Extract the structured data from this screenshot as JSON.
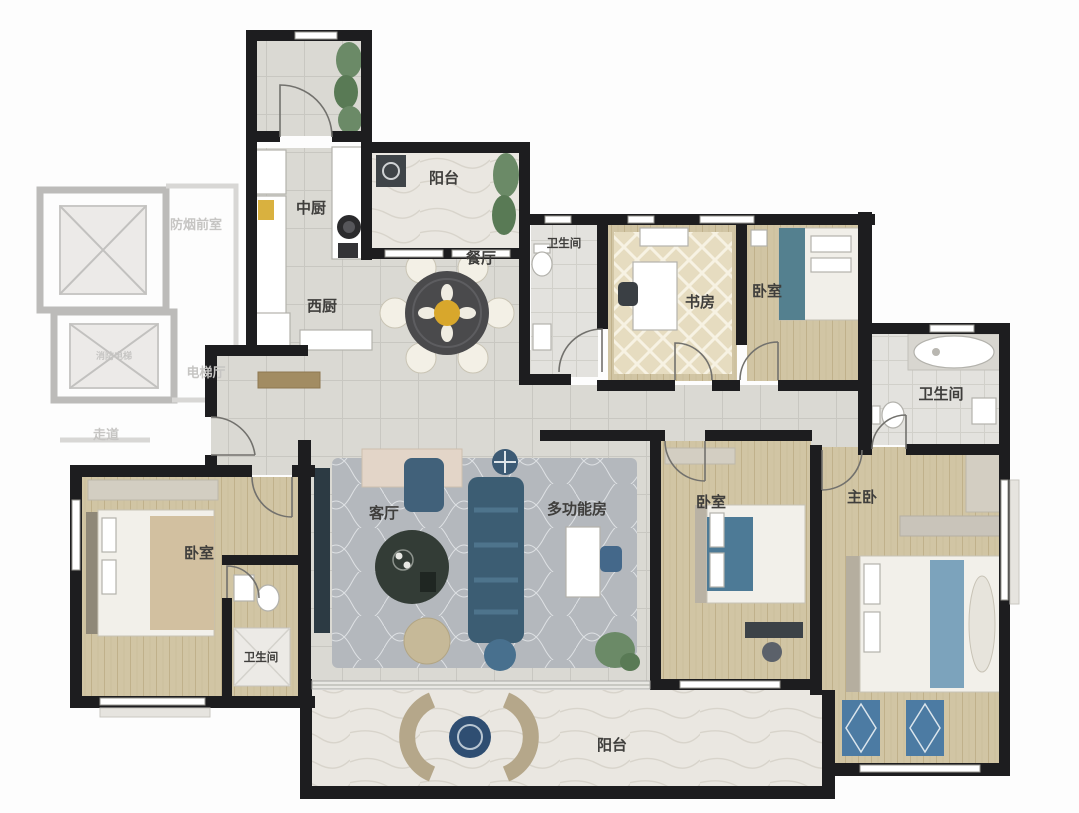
{
  "floorplan": {
    "rooms": [
      {
        "id": "kitchen-chinese",
        "label": "中厨"
      },
      {
        "id": "balcony-top",
        "label": "阳台"
      },
      {
        "id": "kitchen-west",
        "label": "西厨"
      },
      {
        "id": "dining-room",
        "label": "餐厅"
      },
      {
        "id": "bathroom-top",
        "label": "卫生间"
      },
      {
        "id": "study",
        "label": "书房"
      },
      {
        "id": "bedroom-top-right",
        "label": "卧室"
      },
      {
        "id": "bathroom-right",
        "label": "卫生间"
      },
      {
        "id": "living-room",
        "label": "客厅"
      },
      {
        "id": "multifunction-room",
        "label": "多功能房"
      },
      {
        "id": "bedroom-middle",
        "label": "卧室"
      },
      {
        "id": "master-bedroom",
        "label": "主卧"
      },
      {
        "id": "bedroom-left",
        "label": "卧室"
      },
      {
        "id": "bathroom-bottom-left",
        "label": "卫生间"
      },
      {
        "id": "balcony-bottom",
        "label": "阳台"
      }
    ],
    "core_labels": [
      {
        "id": "smoke-lobby",
        "label": "防烟前室"
      },
      {
        "id": "elevator-hall",
        "label": "电梯厅"
      },
      {
        "id": "corridor",
        "label": "走道"
      },
      {
        "id": "fire-elevator",
        "label": "消防电梯"
      }
    ],
    "colors": {
      "wall": "#1d1d1f",
      "tile_floor": "#dad9d3",
      "wood_floor": "#d1c5a4",
      "marble_floor": "#eae7e1",
      "carpet": "#b4b8bd",
      "sofa_blue": "#3c5d73",
      "accent_blue": "#4c7ba3",
      "table_dark": "#4a4a4c",
      "flower_yellow": "#d8a72c",
      "greenery": "#6b8a67",
      "core_gray": "#bcbbb9",
      "label_dark": "#3f3e3c",
      "label_gray": "#c6c5c3"
    }
  }
}
